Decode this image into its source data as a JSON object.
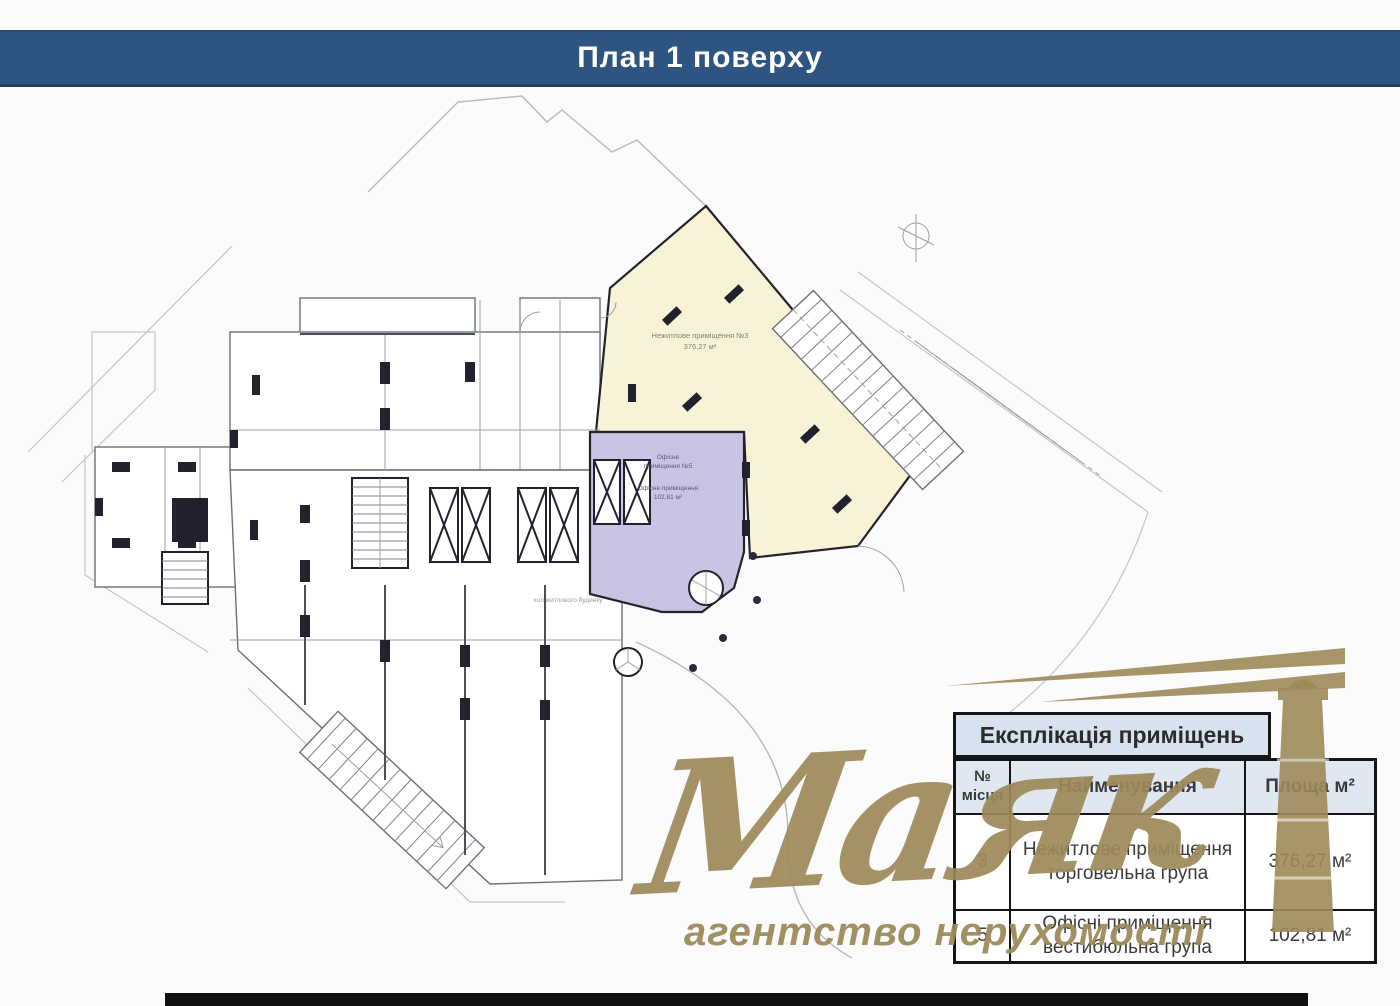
{
  "header": {
    "title": "План 1 поверху",
    "bg_color": "#2e5481"
  },
  "plan": {
    "yellow_area": {
      "line1": "Нежитлове приміщення №3",
      "line2": "376,27 м²",
      "color": "#f8f3d7"
    },
    "purple_area": {
      "block1_line1": "Офісне",
      "block1_line2": "приміщення №5",
      "block2_line1": "Офісне приміщення",
      "block2_line2": "102,81 м²",
      "color": "#c9c4e3"
    },
    "lobby_label": "хол житлового будинку"
  },
  "table": {
    "title": "Експлікація приміщень",
    "columns": {
      "num": "№ місця",
      "name": "Найменування",
      "area": "Площа м²"
    },
    "rows": [
      {
        "num": "3",
        "name": "Нежитлове приміщення торговельна група",
        "area": "376,27 м²"
      },
      {
        "num": "5",
        "name": "Офісні приміщення вестибюльна група",
        "area": "102,81 м²"
      }
    ],
    "header_bg": "#dfe7f1"
  },
  "watermark": {
    "brand": "Маяк",
    "tagline": "агентство нерухомості",
    "color": "#9d895a"
  }
}
